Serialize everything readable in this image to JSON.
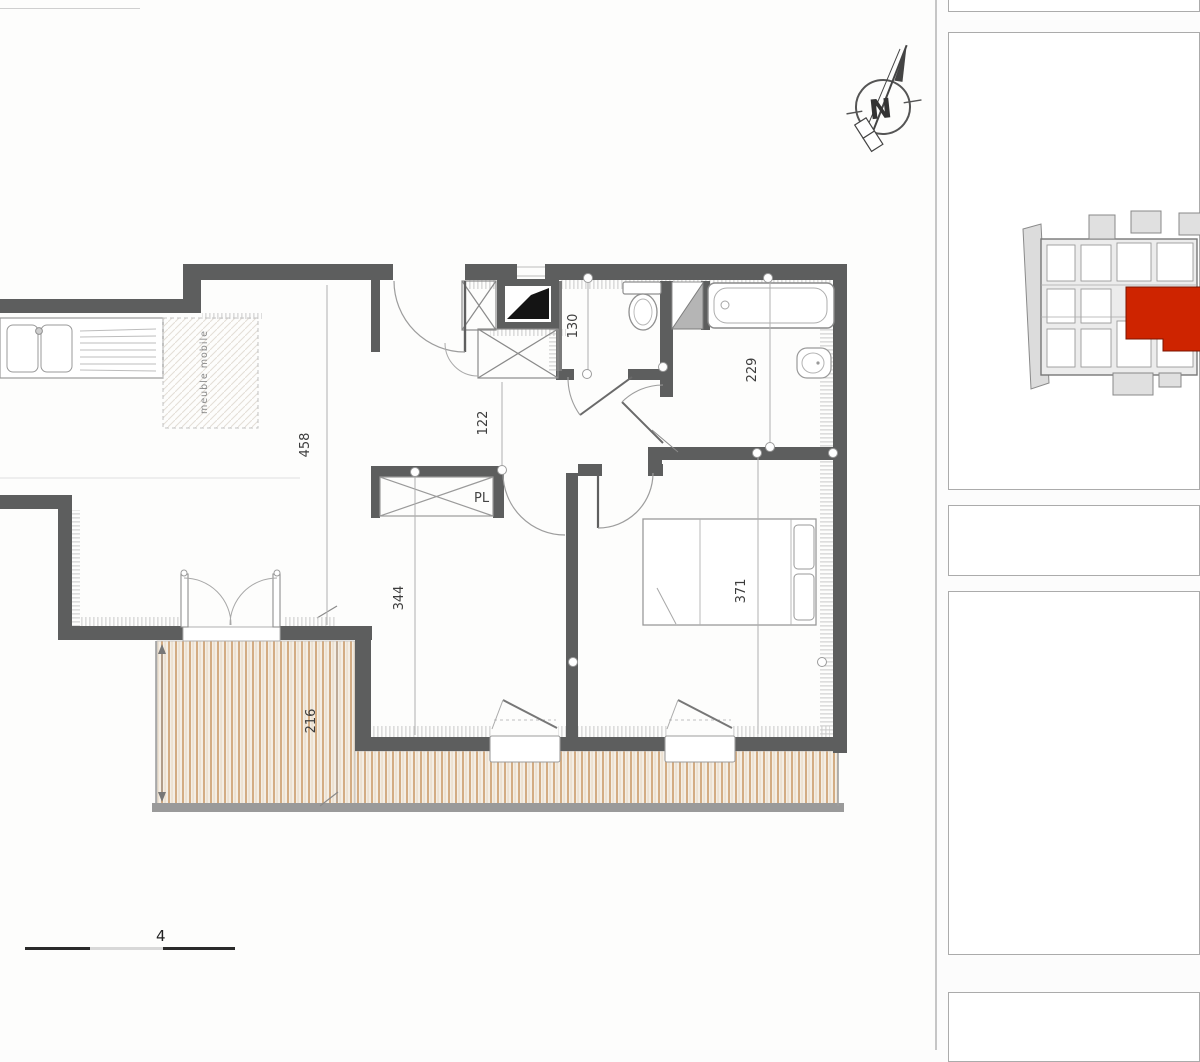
{
  "page": {
    "title_partial": "31000 TOULOUSE",
    "scale_label": "4",
    "compass_letter": "N"
  },
  "plan": {
    "dim_kitchen": "458",
    "dim_living": "344",
    "dim_hall": "122",
    "dim_wc": "130",
    "dim_bath": "229",
    "dim_bedroom": "371",
    "dim_terrace": "216",
    "label_closet": "PL",
    "label_mobile": "meuble mobile"
  },
  "colors": {
    "wall": "#5d5e5e",
    "highlight_red": "#ce2400",
    "deck_line": "#d3ac83",
    "hatch": "#c8c8c8"
  }
}
